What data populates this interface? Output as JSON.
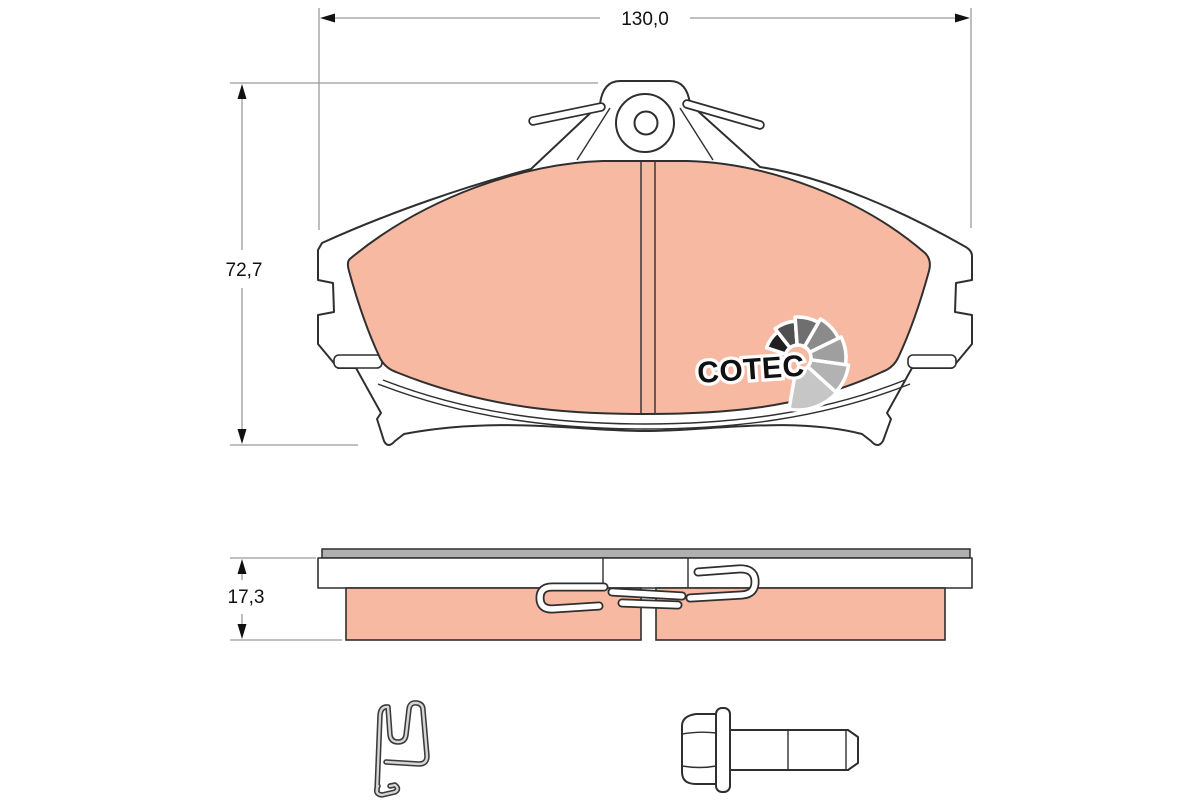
{
  "drawing": {
    "dimensions": {
      "width": "130,0",
      "height": "72,7",
      "thickness": "17,3"
    },
    "logo": {
      "text": "COTEC"
    }
  },
  "colors": {
    "background": "#ffffff",
    "friction": "#f8b9a2",
    "outline": "#2f2f2f",
    "dim_line": "#9a9a9a",
    "dim_text": "#111111",
    "shim": "#b0b0b0",
    "metal_light": "#d6d6d6",
    "metal_dark": "#3a3a3a",
    "logo_text": "#111111",
    "logo_halo": "#ffffff",
    "fan_shades": [
      "#1f1f1f",
      "#505050",
      "#6f6f6f",
      "#8b8b8b",
      "#9f9f9f",
      "#b2b2b2",
      "#c6c6c6"
    ]
  }
}
